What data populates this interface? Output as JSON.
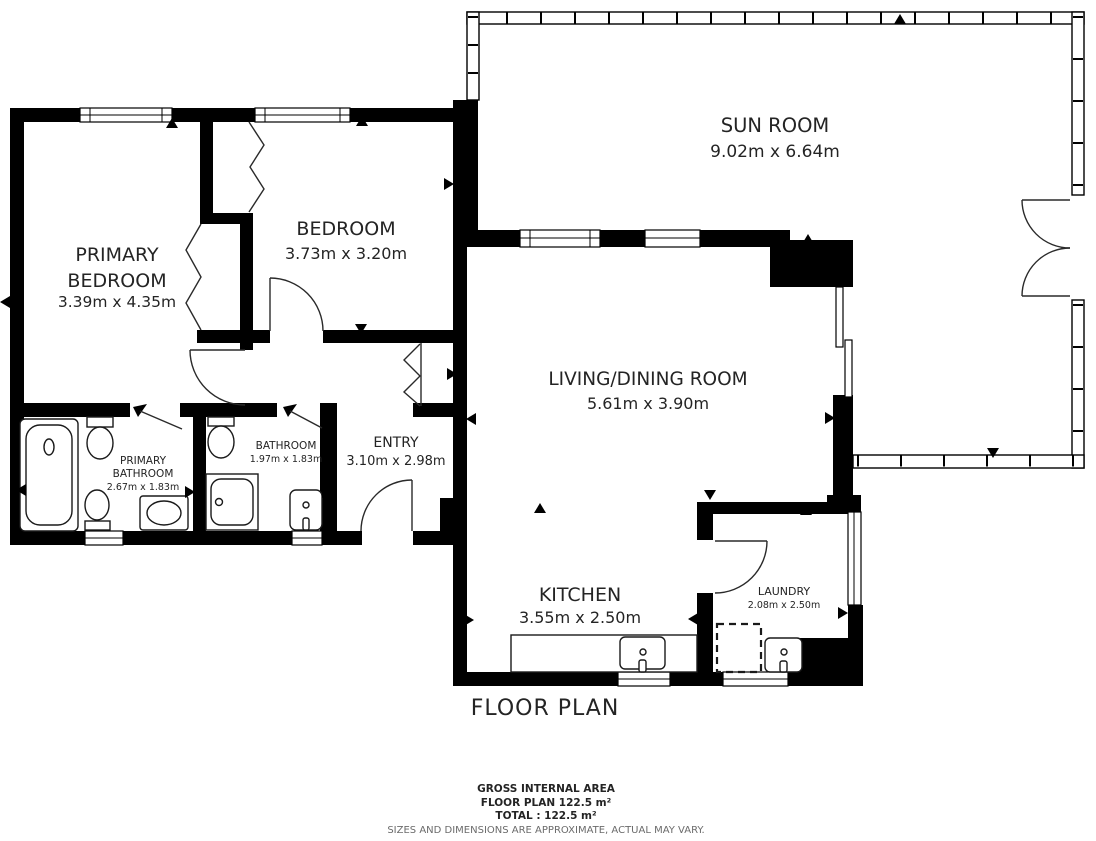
{
  "title": "FLOOR PLAN",
  "rooms": {
    "sun_room": {
      "name": "SUN ROOM",
      "dims": "9.02m x 6.64m"
    },
    "primary_bedroom": {
      "name_line1": "PRIMARY",
      "name_line2": "BEDROOM",
      "dims": "3.39m x 4.35m"
    },
    "bedroom": {
      "name": "BEDROOM",
      "dims": "3.73m x 3.20m"
    },
    "living_dining": {
      "name": "LIVING/DINING ROOM",
      "dims": "5.61m x 3.90m"
    },
    "entry": {
      "name": "ENTRY",
      "dims": "3.10m x 2.98m"
    },
    "primary_bathroom": {
      "name_line1": "PRIMARY",
      "name_line2": "BATHROOM",
      "dims": "2.67m x 1.83m"
    },
    "bathroom": {
      "name": "BATHROOM",
      "dims": "1.97m x 1.83m"
    },
    "kitchen": {
      "name": "KITCHEN",
      "dims": "3.55m x 2.50m"
    },
    "laundry": {
      "name": "LAUNDRY",
      "dims": "2.08m x 2.50m"
    }
  },
  "footer": {
    "line1": "GROSS INTERNAL AREA",
    "line2": "FLOOR PLAN 122.5 m²",
    "line3": "TOTAL :  122.5 m²",
    "disclaimer": "SIZES AND DIMENSIONS ARE APPROXIMATE, ACTUAL MAY VARY."
  },
  "colors": {
    "wall": "#000000",
    "background": "#ffffff",
    "label": "#242424",
    "muted": "#6b6b6b"
  }
}
